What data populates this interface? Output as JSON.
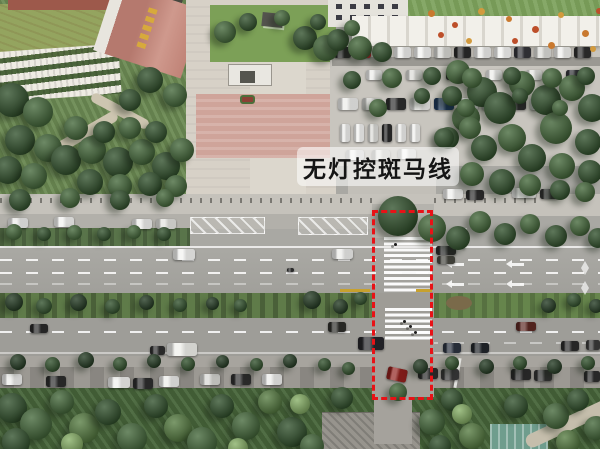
{
  "annotation": {
    "label": "无灯控斑马线",
    "label_text_color": "#151515",
    "label_bg_opacity": 0.55,
    "box_color": "#e81217"
  },
  "scene": {
    "palette": {
      "d1": "#233a22",
      "d2": "#31512c",
      "m": "#44683a",
      "g": "#567c41",
      "l": "#6f9a52",
      "ll": "#87b066"
    },
    "trees": [
      [
        12,
        100,
        34,
        "d2"
      ],
      [
        38,
        112,
        30,
        "m"
      ],
      [
        20,
        140,
        30,
        "d2"
      ],
      [
        48,
        148,
        28,
        "m"
      ],
      [
        8,
        170,
        28,
        "d2"
      ],
      [
        34,
        176,
        26,
        "m"
      ],
      [
        66,
        160,
        30,
        "d2"
      ],
      [
        92,
        150,
        28,
        "m"
      ],
      [
        118,
        162,
        30,
        "d2"
      ],
      [
        142,
        152,
        26,
        "m"
      ],
      [
        166,
        166,
        28,
        "d2"
      ],
      [
        182,
        150,
        24,
        "m"
      ],
      [
        76,
        128,
        24,
        "m"
      ],
      [
        104,
        132,
        22,
        "d2"
      ],
      [
        130,
        128,
        22,
        "m"
      ],
      [
        156,
        132,
        22,
        "d2"
      ],
      [
        90,
        182,
        26,
        "d2"
      ],
      [
        120,
        186,
        24,
        "m"
      ],
      [
        150,
        184,
        24,
        "d2"
      ],
      [
        176,
        186,
        22,
        "m"
      ],
      [
        150,
        80,
        26,
        "d2"
      ],
      [
        175,
        95,
        24,
        "m"
      ],
      [
        130,
        100,
        22,
        "d2"
      ],
      [
        225,
        32,
        22,
        "m"
      ],
      [
        248,
        22,
        18,
        "d2"
      ],
      [
        282,
        18,
        16,
        "m"
      ],
      [
        305,
        38,
        24,
        "d2"
      ],
      [
        326,
        48,
        26,
        "m"
      ],
      [
        318,
        22,
        16,
        "d2"
      ],
      [
        338,
        40,
        22,
        "d2"
      ],
      [
        360,
        48,
        24,
        "m"
      ],
      [
        382,
        52,
        20,
        "d2"
      ],
      [
        352,
        28,
        16,
        "m"
      ],
      [
        458,
        72,
        24,
        "m"
      ],
      [
        482,
        92,
        30,
        "d2"
      ],
      [
        466,
        118,
        28,
        "m"
      ],
      [
        500,
        108,
        32,
        "d2"
      ],
      [
        522,
        84,
        26,
        "m"
      ],
      [
        546,
        100,
        30,
        "d2"
      ],
      [
        572,
        88,
        26,
        "m"
      ],
      [
        592,
        108,
        28,
        "d2"
      ],
      [
        556,
        128,
        32,
        "m"
      ],
      [
        588,
        142,
        26,
        "d2"
      ],
      [
        512,
        138,
        28,
        "m"
      ],
      [
        484,
        148,
        26,
        "d2"
      ],
      [
        532,
        158,
        28,
        "d2"
      ],
      [
        562,
        166,
        26,
        "m"
      ],
      [
        590,
        172,
        24,
        "d2"
      ],
      [
        472,
        174,
        24,
        "m"
      ],
      [
        502,
        182,
        26,
        "d2"
      ],
      [
        448,
        138,
        22,
        "d2"
      ],
      [
        452,
        96,
        20,
        "d2"
      ],
      [
        530,
        185,
        22,
        "m"
      ],
      [
        560,
        190,
        20,
        "d2"
      ],
      [
        585,
        192,
        20,
        "m"
      ],
      [
        352,
        80,
        18,
        "d2"
      ],
      [
        392,
        78,
        20,
        "m"
      ],
      [
        432,
        76,
        18,
        "d2"
      ],
      [
        472,
        78,
        20,
        "m"
      ],
      [
        512,
        76,
        18,
        "d2"
      ],
      [
        552,
        78,
        20,
        "m"
      ],
      [
        586,
        76,
        18,
        "d2"
      ],
      [
        378,
        108,
        18,
        "m"
      ],
      [
        422,
        96,
        16,
        "d2"
      ],
      [
        466,
        108,
        18,
        "m"
      ],
      [
        520,
        96,
        16,
        "d2"
      ],
      [
        560,
        108,
        16,
        "m"
      ],
      [
        444,
        138,
        20,
        "d2"
      ],
      [
        470,
        128,
        22,
        "m"
      ],
      [
        20,
        200,
        22,
        "d2"
      ],
      [
        70,
        198,
        20,
        "m"
      ],
      [
        120,
        200,
        20,
        "d2"
      ],
      [
        165,
        198,
        18,
        "m"
      ],
      [
        398,
        216,
        40,
        "d2"
      ],
      [
        432,
        228,
        28,
        "m"
      ],
      [
        458,
        238,
        24,
        "d2"
      ],
      [
        480,
        222,
        22,
        "m"
      ],
      [
        505,
        234,
        22,
        "d2"
      ],
      [
        530,
        224,
        20,
        "m"
      ],
      [
        556,
        236,
        22,
        "d2"
      ],
      [
        580,
        226,
        20,
        "m"
      ],
      [
        598,
        238,
        20,
        "d2"
      ],
      [
        14,
        232,
        16,
        "m"
      ],
      [
        44,
        234,
        14,
        "d2"
      ],
      [
        74,
        232,
        15,
        "m"
      ],
      [
        104,
        234,
        14,
        "d2"
      ],
      [
        134,
        232,
        14,
        "m"
      ],
      [
        164,
        234,
        14,
        "d2"
      ],
      [
        14,
        302,
        18,
        "d1"
      ],
      [
        44,
        306,
        16,
        "d2"
      ],
      [
        78,
        302,
        17,
        "d1"
      ],
      [
        112,
        306,
        15,
        "d2"
      ],
      [
        146,
        302,
        15,
        "d1"
      ],
      [
        180,
        305,
        14,
        "d2"
      ],
      [
        212,
        303,
        13,
        "d1"
      ],
      [
        240,
        305,
        13,
        "d2"
      ],
      [
        312,
        300,
        18,
        "d1"
      ],
      [
        340,
        306,
        15,
        "d1"
      ],
      [
        360,
        298,
        13,
        "d2"
      ],
      [
        548,
        305,
        15,
        "d1"
      ],
      [
        574,
        300,
        14,
        "d2"
      ],
      [
        596,
        306,
        14,
        "d1"
      ],
      [
        18,
        362,
        16,
        "d1"
      ],
      [
        52,
        364,
        15,
        "d2"
      ],
      [
        86,
        360,
        16,
        "d1"
      ],
      [
        120,
        364,
        14,
        "d2"
      ],
      [
        154,
        361,
        14,
        "d1"
      ],
      [
        188,
        364,
        14,
        "d2"
      ],
      [
        222,
        361,
        13,
        "d1"
      ],
      [
        256,
        364,
        13,
        "d2"
      ],
      [
        290,
        361,
        14,
        "d1"
      ],
      [
        324,
        364,
        13,
        "d2"
      ],
      [
        348,
        368,
        13,
        "d2"
      ],
      [
        420,
        366,
        15,
        "d1"
      ],
      [
        452,
        363,
        14,
        "d2"
      ],
      [
        486,
        366,
        15,
        "d1"
      ],
      [
        520,
        363,
        14,
        "d2"
      ],
      [
        554,
        366,
        15,
        "d1"
      ],
      [
        588,
        363,
        14,
        "d2"
      ],
      [
        12,
        408,
        30,
        "d2"
      ],
      [
        36,
        424,
        32,
        "m"
      ],
      [
        16,
        442,
        28,
        "d2"
      ],
      [
        62,
        402,
        24,
        "m"
      ],
      [
        84,
        428,
        30,
        "g"
      ],
      [
        108,
        412,
        26,
        "d2"
      ],
      [
        132,
        438,
        30,
        "m"
      ],
      [
        156,
        406,
        24,
        "d2"
      ],
      [
        178,
        428,
        28,
        "g"
      ],
      [
        202,
        442,
        30,
        "m"
      ],
      [
        222,
        406,
        24,
        "d2"
      ],
      [
        246,
        426,
        28,
        "m"
      ],
      [
        270,
        402,
        24,
        "g"
      ],
      [
        292,
        432,
        30,
        "d2"
      ],
      [
        312,
        446,
        24,
        "m"
      ],
      [
        342,
        398,
        22,
        "d2"
      ],
      [
        432,
        422,
        26,
        "m"
      ],
      [
        452,
        400,
        22,
        "d2"
      ],
      [
        472,
        436,
        26,
        "g"
      ],
      [
        516,
        406,
        24,
        "d2"
      ],
      [
        556,
        416,
        26,
        "m"
      ],
      [
        578,
        400,
        22,
        "d2"
      ],
      [
        568,
        442,
        24,
        "g"
      ],
      [
        596,
        428,
        24,
        "m"
      ],
      [
        440,
        446,
        22,
        "d2"
      ],
      [
        462,
        414,
        20,
        "ll"
      ],
      [
        300,
        404,
        20,
        "ll"
      ],
      [
        72,
        444,
        22,
        "ll"
      ],
      [
        238,
        448,
        20,
        "ll"
      ],
      [
        398,
        392,
        18,
        "m"
      ]
    ],
    "cars": [
      [
        334,
        47,
        17,
        11,
        "#2b2b2b"
      ],
      [
        354,
        47,
        17,
        11,
        "#b5242a"
      ],
      [
        374,
        47,
        17,
        11,
        "#3a3a3a"
      ],
      [
        394,
        47,
        17,
        11,
        "#ececea"
      ],
      [
        414,
        47,
        17,
        11,
        "#f4f4f2"
      ],
      [
        434,
        47,
        17,
        11,
        "#d6d6d2"
      ],
      [
        454,
        47,
        17,
        11,
        "#2a2a2a"
      ],
      [
        474,
        47,
        17,
        11,
        "#ececea"
      ],
      [
        494,
        47,
        17,
        11,
        "#f4f4f2"
      ],
      [
        514,
        47,
        17,
        11,
        "#35353a"
      ],
      [
        534,
        47,
        17,
        11,
        "#dcdcd8"
      ],
      [
        554,
        47,
        17,
        11,
        "#f0f0ee"
      ],
      [
        574,
        47,
        17,
        11,
        "#2e2e2e"
      ],
      [
        366,
        70,
        16,
        10,
        "#ececea"
      ],
      [
        406,
        70,
        16,
        10,
        "#dadad6"
      ],
      [
        446,
        70,
        16,
        10,
        "#2f2f2f"
      ],
      [
        486,
        70,
        16,
        10,
        "#ececea"
      ],
      [
        526,
        70,
        16,
        10,
        "#e4e4e0"
      ],
      [
        566,
        70,
        16,
        10,
        "#34343a"
      ],
      [
        338,
        98,
        20,
        12,
        "#ececea"
      ],
      [
        362,
        98,
        20,
        12,
        "#d0d0cc"
      ],
      [
        386,
        98,
        20,
        12,
        "#2e2e2e"
      ],
      [
        410,
        98,
        20,
        12,
        "#ececea"
      ],
      [
        434,
        98,
        20,
        12,
        "#1f3a60"
      ],
      [
        458,
        98,
        20,
        12,
        "#ececea"
      ],
      [
        482,
        98,
        20,
        12,
        "#d8d8d4"
      ],
      [
        506,
        98,
        20,
        12,
        "#2c2c2c"
      ],
      [
        530,
        98,
        20,
        12,
        "#ececea"
      ],
      [
        340,
        124,
        10,
        18,
        "#ececea"
      ],
      [
        354,
        124,
        10,
        18,
        "#f4f4f2"
      ],
      [
        368,
        124,
        10,
        18,
        "#dcdcd8"
      ],
      [
        382,
        124,
        10,
        18,
        "#2a2a2a"
      ],
      [
        396,
        124,
        10,
        18,
        "#ececea"
      ],
      [
        410,
        124,
        10,
        18,
        "#f0f0ee"
      ],
      [
        346,
        150,
        18,
        10,
        "#ececea"
      ],
      [
        372,
        150,
        18,
        10,
        "#dedeD8"
      ],
      [
        398,
        149,
        18,
        10,
        "#f0f0ee"
      ],
      [
        8,
        218,
        20,
        10,
        "#ececea"
      ],
      [
        54,
        217,
        20,
        10,
        "#f2f2f0"
      ],
      [
        132,
        219,
        20,
        10,
        "#ececea"
      ],
      [
        156,
        219,
        20,
        10,
        "#e2e2de"
      ],
      [
        443,
        189,
        20,
        10,
        "#f0f0ee"
      ],
      [
        466,
        190,
        18,
        10,
        "#2d2d2d"
      ],
      [
        512,
        188,
        24,
        10,
        "#f0f0ee"
      ],
      [
        540,
        189,
        18,
        10,
        "#333333"
      ],
      [
        436,
        246,
        20,
        9,
        "#2c2c2c"
      ],
      [
        437,
        256,
        18,
        8,
        "#46463f"
      ],
      [
        173,
        249,
        22,
        11,
        "#f2f2f0"
      ],
      [
        332,
        249,
        21,
        10,
        "#ececea"
      ],
      [
        287,
        268,
        7,
        4,
        "#2f2f2f"
      ],
      [
        30,
        324,
        18,
        9,
        "#2a2a2a"
      ],
      [
        328,
        322,
        18,
        10,
        "#2e2e2a"
      ],
      [
        516,
        322,
        20,
        9,
        "#5c2822"
      ],
      [
        150,
        346,
        15,
        9,
        "#2f2f2f"
      ],
      [
        167,
        343,
        30,
        13,
        "#efefeb"
      ],
      [
        358,
        337,
        26,
        13,
        "#26262b"
      ],
      [
        443,
        343,
        18,
        10,
        "#2c3340"
      ],
      [
        471,
        343,
        18,
        10,
        "#22262b"
      ],
      [
        561,
        341,
        18,
        10,
        "#2b2b2b"
      ],
      [
        586,
        340,
        14,
        10,
        "#3a3a3a"
      ],
      [
        2,
        374,
        20,
        11,
        "#ececea"
      ],
      [
        46,
        376,
        20,
        11,
        "#2c2c2c"
      ],
      [
        108,
        377,
        22,
        11,
        "#f0f0ee"
      ],
      [
        133,
        378,
        20,
        11,
        "#2e2e2e"
      ],
      [
        159,
        376,
        20,
        11,
        "#ececea"
      ],
      [
        200,
        374,
        20,
        11,
        "#d6d6d2"
      ],
      [
        231,
        374,
        20,
        11,
        "#2f2f2f"
      ],
      [
        262,
        374,
        20,
        11,
        "#ececea"
      ],
      [
        418,
        368,
        20,
        11,
        "#2b2b2b"
      ],
      [
        441,
        369,
        18,
        11,
        "#3a3a3a"
      ],
      [
        511,
        369,
        20,
        11,
        "#2c2c2c"
      ],
      [
        534,
        370,
        18,
        11,
        "#343434"
      ],
      [
        584,
        371,
        16,
        11,
        "#2e2e2e"
      ],
      [
        387,
        368,
        20,
        13,
        "#8f201c",
        12
      ]
    ],
    "flowers": [
      [
        428,
        10,
        7,
        "#c9792f"
      ],
      [
        452,
        22,
        6,
        "#bd4f2a"
      ],
      [
        478,
        8,
        7,
        "#d29a3d"
      ],
      [
        506,
        16,
        6,
        "#c9792f"
      ],
      [
        532,
        26,
        7,
        "#bd4f2a"
      ],
      [
        558,
        12,
        6,
        "#d29a3d"
      ],
      [
        582,
        30,
        7,
        "#c9792f"
      ],
      [
        596,
        8,
        6,
        "#bd4f2a"
      ],
      [
        466,
        38,
        6,
        "#d29a3d"
      ],
      [
        438,
        32,
        6,
        "#bd4f2a"
      ],
      [
        548,
        42,
        7,
        "#c9792f"
      ],
      [
        590,
        46,
        6,
        "#d29a3d"
      ],
      [
        512,
        38,
        6,
        "#bd4f2a"
      ]
    ],
    "pedestrians": [
      [
        394,
        243
      ],
      [
        403,
        320
      ],
      [
        409,
        325
      ],
      [
        414,
        331
      ]
    ],
    "road_markings": {
      "arrows": [
        [
          452,
          263
        ],
        [
          512,
          263
        ],
        [
          452,
          283
        ],
        [
          512,
          283
        ]
      ],
      "diamonds": [
        [
          581,
          261
        ],
        [
          581,
          281
        ]
      ],
      "yellow_dashes": [
        [
          340,
          289,
          30,
          3
        ],
        [
          416,
          289,
          16,
          3
        ]
      ]
    }
  }
}
